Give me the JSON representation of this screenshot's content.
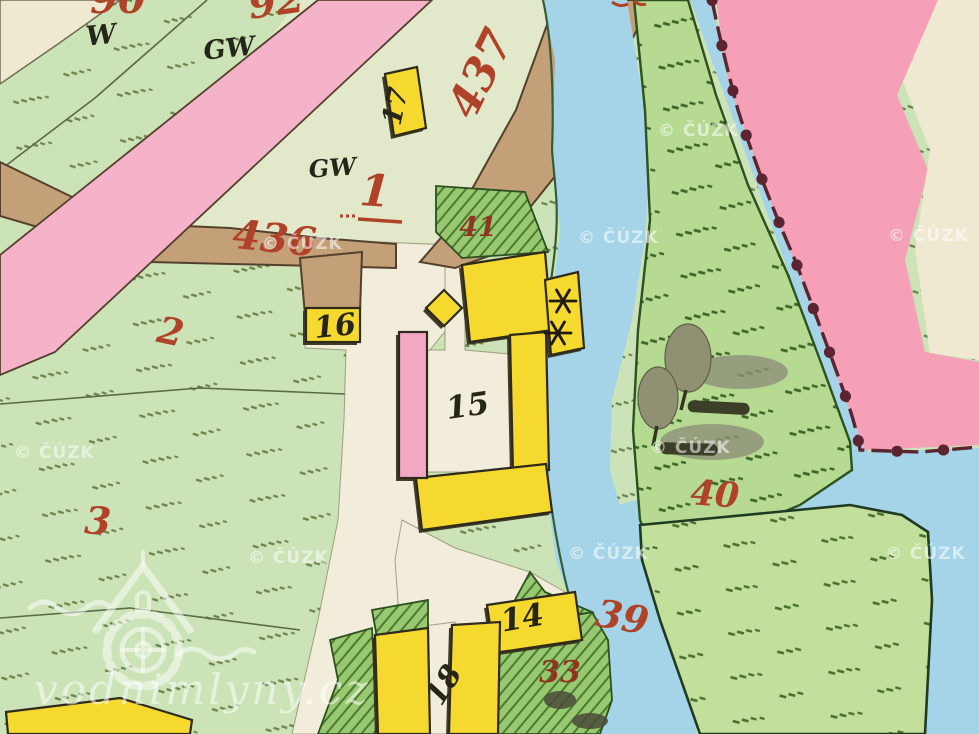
{
  "map": {
    "type": "historical-cadastral-map",
    "labels": {
      "red": [
        "90",
        "92",
        "437",
        "436",
        "1",
        "2",
        "3",
        "41",
        "40",
        "39",
        "33"
      ],
      "black": [
        "W",
        "GW",
        "GW",
        "17",
        "16",
        "15",
        "14",
        "18"
      ]
    },
    "watermarks": {
      "copyright": "© ČÚZK",
      "site": "vodnimlyny.cz"
    },
    "colors": {
      "field_light_green": "#cbe3b6",
      "field_right_green": "#b6da92",
      "wedge_green": "#c2df9c",
      "garden_green": "#98c870",
      "water_blue": "#a5d4e8",
      "road_pink": "#f5b3ca",
      "band_pink_right": "#f5a0b6",
      "road_tan": "#c4a079",
      "village_white": "#f2edda",
      "cream": "#efe9d2",
      "building_yellow": "#f6d92f",
      "building_pink": "#f2a7c3",
      "label_red": "#b04229",
      "border_maroon": "#5c2430",
      "ink_black": "#262519"
    }
  }
}
